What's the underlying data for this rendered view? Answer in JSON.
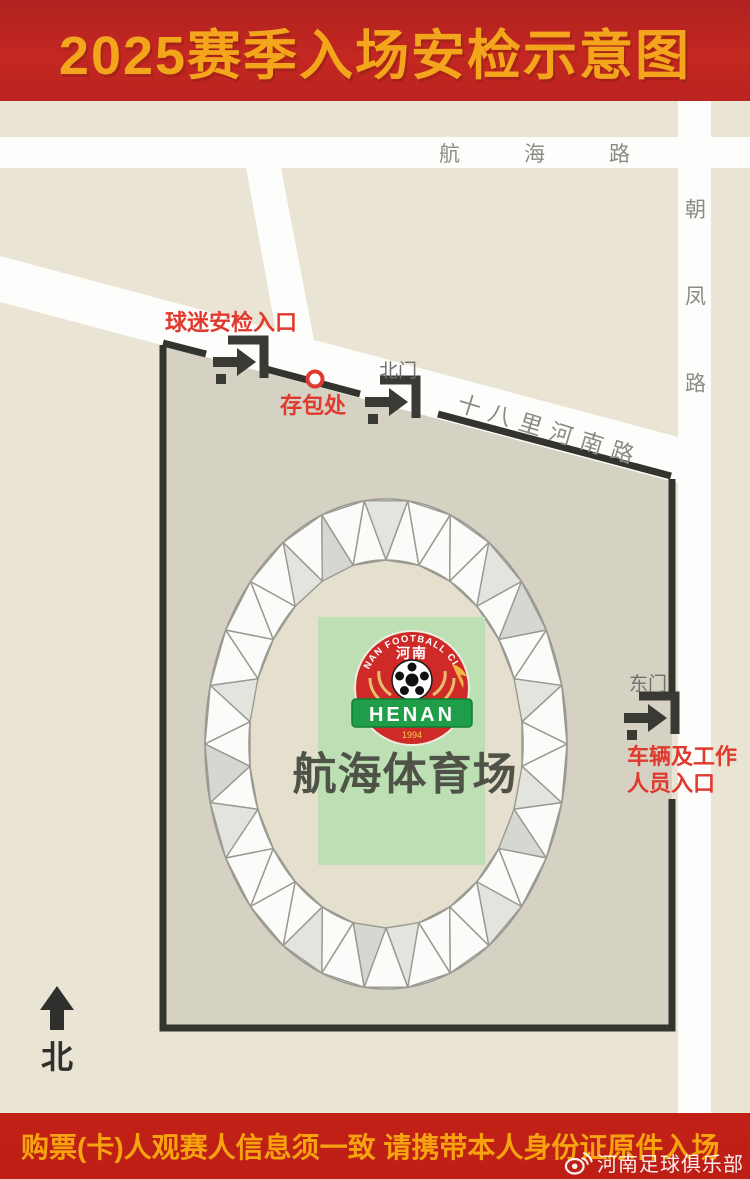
{
  "header": {
    "title": "2025赛季入场安检示意图"
  },
  "map": {
    "roads": {
      "hanghai": "航海路",
      "chaofeng": "朝凤路",
      "shibalihe": "十八里河南路"
    },
    "labels": {
      "fan_entrance": "球迷安检入口",
      "bag_storage": "存包处",
      "north_gate": "北门",
      "east_gate": "东门",
      "vehicle_line1": "车辆及工作",
      "vehicle_line2": "人员入口",
      "north_compass": "北"
    },
    "stadium": {
      "name": "航海体育场",
      "logo": {
        "club_en": "HENAN FOOTBALL CLUB",
        "club_cn": "河南",
        "banner": "HENAN",
        "year": "1994"
      }
    }
  },
  "footer": {
    "notice": "购票(卡)人观赛人信息须一致 请携带本人身份证原件入场",
    "watermark": "河南足球俱乐部"
  },
  "colors": {
    "header_bg": "#bc2420",
    "title_text": "#f3a51c",
    "map_bg": "#e9e4d3",
    "compound_fill": "#d5d1c3",
    "road_white": "#fdfdfb",
    "road_label_gray": "#8b8b86",
    "boundary_dark": "#34342e",
    "red_label": "#e0392e",
    "field_green_rect": "#bcdfb4",
    "stadium_text": "#4e5247",
    "ring_facet_gray": "#dadad4",
    "banner_bg": "#bf1f16",
    "banner_text": "#f6a30f",
    "logo_red": "#ce2a27",
    "logo_green": "#1f9d48"
  }
}
